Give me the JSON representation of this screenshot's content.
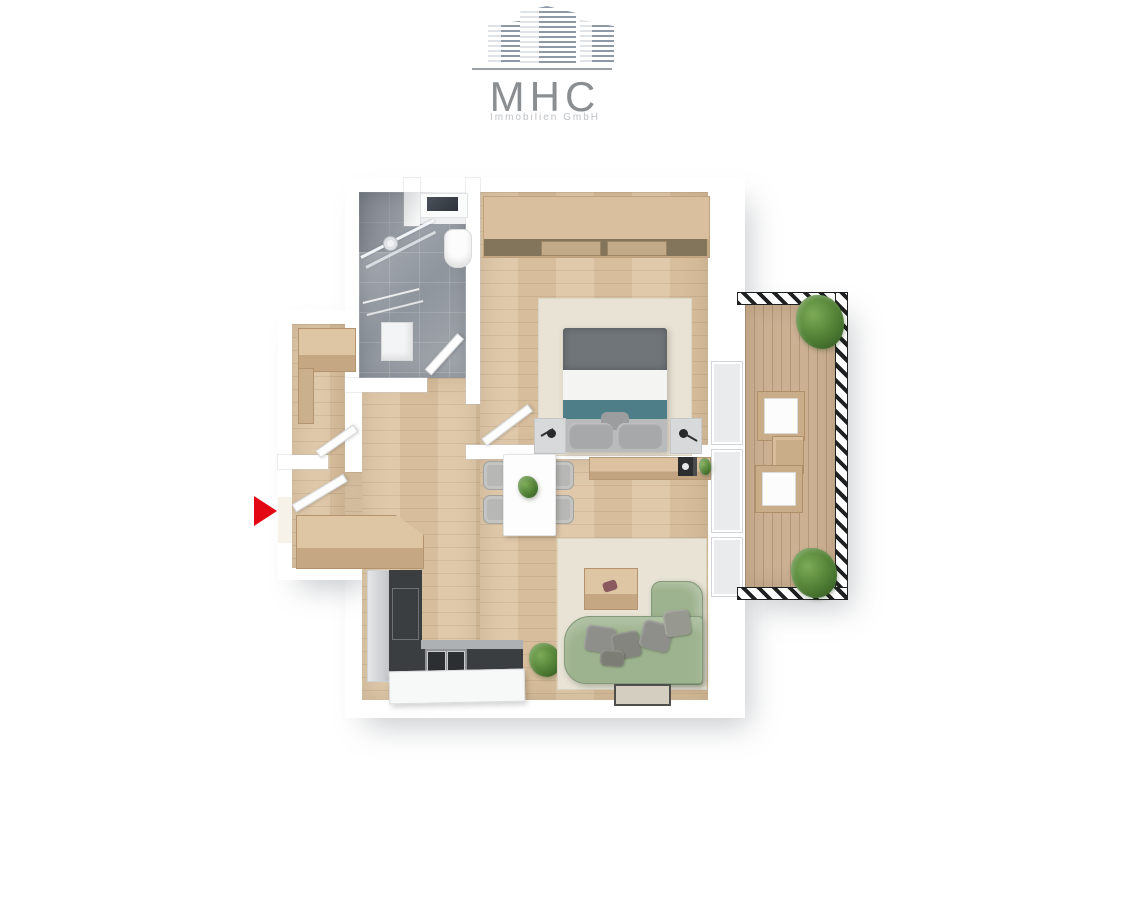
{
  "logo": {
    "title": "MHC",
    "subtitle": "Immobilien GmbH"
  },
  "palette": {
    "accent-red": "#e30613",
    "logo-text": "#8a8e91",
    "logo-subtext": "#bfc2c5",
    "logo-building": "#8e99a8",
    "wall-white": "#ffffff",
    "wood-floor": "#dcc3a2",
    "balcony-deck": "#cbb092",
    "tile-gray": "#9aa0a7",
    "kitchen-dark": "#3b3e41",
    "sofa-green": "#9db28e",
    "bed-teal": "#4e7f88",
    "bed-gray": "#70757a",
    "rug-beige": "#e9e3d5"
  }
}
